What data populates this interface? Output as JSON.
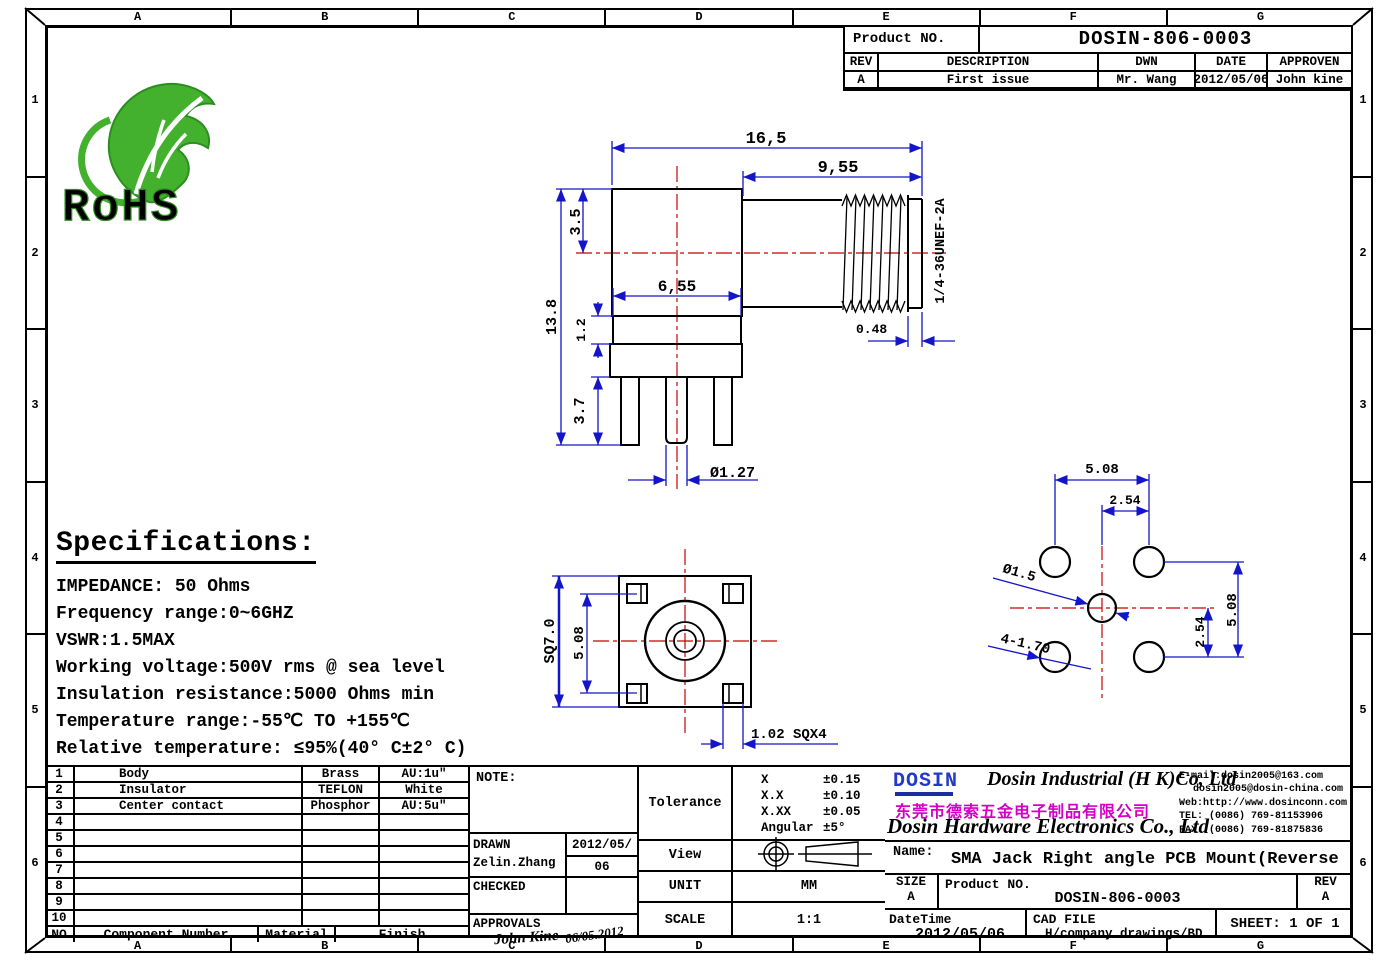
{
  "frame": {
    "cols": [
      "A",
      "B",
      "C",
      "D",
      "E",
      "F",
      "G"
    ],
    "rows": [
      "1",
      "2",
      "3",
      "4",
      "5",
      "6"
    ]
  },
  "rohs": {
    "label": "RoHS"
  },
  "rev_table": {
    "product_no_label": "Product NO.",
    "product_no": "DOSIN-806-0003",
    "headers": [
      "REV",
      "DESCRIPTION",
      "DWN",
      "DATE",
      "APPROVEN"
    ],
    "rows": [
      [
        "A",
        "First issue",
        "Mr. Wang",
        "2012/05/06",
        "John kine"
      ]
    ]
  },
  "specs": {
    "title": "Specifications:",
    "lines": [
      "IMPEDANCE: 50 Ohms",
      "Frequency range:0~6GHZ",
      "VSWR:1.5MAX",
      "Working voltage:500V rms @ sea level",
      "Insulation resistance:5000 Ohms min",
      "Temperature range:-55℃ TO +155℃",
      "Relative temperature: ≤95%(40° C±2° C)"
    ]
  },
  "dims": {
    "d165": "16,5",
    "d955": "9,55",
    "d35": "3.5",
    "d138": "13.8",
    "d655": "6,55",
    "d12": "1.2",
    "d37": "3.7",
    "d127": "Ø1.27",
    "thread": "1/4-36UNEF-2A",
    "d048": "0.48",
    "sq70": "SQ7.0",
    "bv508": "5.08",
    "sqx4": "1.02 SQX4",
    "fp508t": "5.08",
    "fp254t": "2.54",
    "fp15": "Ø1.5",
    "fp170": "4-1.70",
    "fp508r": "5.08",
    "fp254r": "2.54"
  },
  "bom": {
    "rows": [
      [
        "1",
        "Body",
        "Brass",
        "AU:1u\""
      ],
      [
        "2",
        "Insulator",
        "TEFLON",
        "White"
      ],
      [
        "3",
        "Center contact",
        "Phosphor",
        "AU:5u\""
      ],
      [
        "4",
        "",
        "",
        ""
      ],
      [
        "5",
        "",
        "",
        ""
      ],
      [
        "6",
        "",
        "",
        ""
      ],
      [
        "7",
        "",
        "",
        ""
      ],
      [
        "8",
        "",
        "",
        ""
      ],
      [
        "9",
        "",
        "",
        ""
      ],
      [
        "10",
        "",
        "",
        ""
      ]
    ],
    "footer": [
      "NO",
      "Component Number",
      "Material",
      "Finish"
    ]
  },
  "sign": {
    "note_label": "NOTE:",
    "drawn_label": "DRAWN",
    "drawn_name": "Zelin.Zhang",
    "drawn_date_1": "2012/05/",
    "drawn_date_2": "06",
    "checked_label": "CHECKED",
    "approvals_label": "APPROVALS",
    "signature": "John Kine",
    "signature_date": "06/05.2012"
  },
  "tolerance": {
    "label": "Tolerance",
    "rows": [
      [
        "X",
        "±0.15"
      ],
      [
        "X.X",
        "±0.10"
      ],
      [
        "X.XX",
        "±0.05"
      ],
      [
        "Angular",
        "±5°"
      ]
    ]
  },
  "view": {
    "label": "View"
  },
  "unit": {
    "label": "UNIT",
    "value": "MM"
  },
  "scale": {
    "label": "SCALE",
    "value": "1:1"
  },
  "company": {
    "logo": "DOSIN",
    "name_en1": "Dosin Industrial (H K)Co, Ltd",
    "name_cn": "东莞市德索五金电子制品有限公司",
    "name_en2": "Dosin Hardware Electronics Co., Ltd",
    "email1": "E-mail:dosin2005@163.com",
    "email2": "dosin2005@dosin-china.com",
    "web": "Web:http://www.dosinconn.com",
    "tel": "TEL: (0086) 769-81153906",
    "fax": "FAX: (0086) 769-81875836"
  },
  "title_block": {
    "name_label": "Name:",
    "name_value": "SMA Jack Right angle PCB Mount(Reverse",
    "size_label": "SIZE",
    "size_value": "A",
    "product_no_label": "Product NO.",
    "product_no": "DOSIN-806-0003",
    "rev_label": "REV",
    "rev_value": "A",
    "datetime_label": "DateTime",
    "datetime_value": "2012/05/06",
    "cad_label": "CAD FILE",
    "cad_value": "H/company drawings/BD",
    "sheet": "SHEET: 1 OF 1"
  },
  "colors": {
    "dimension_blue": "#1414c8",
    "centerline_red": "#c80000",
    "rohs_green": "#3cb32c",
    "company_magenta": "#d400c8",
    "logo_blue": "#2239c9"
  }
}
